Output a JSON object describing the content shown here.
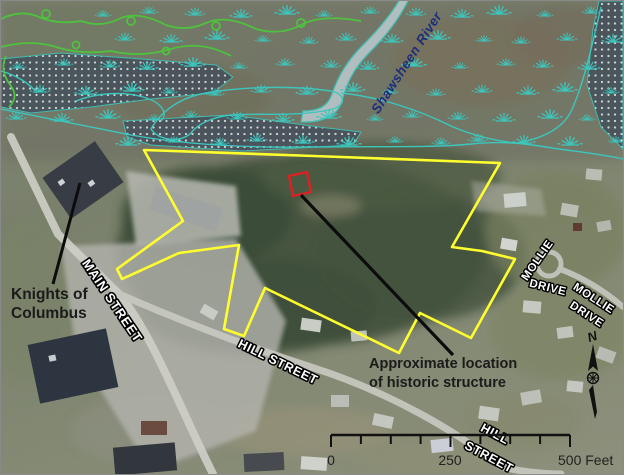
{
  "map": {
    "annotations": {
      "knights_line1": "Knights of",
      "knights_line2": "Columbus",
      "approx_line1": "Approximate location",
      "approx_line2": "of historic structure"
    },
    "streets": {
      "main": "MAIN STREET",
      "hill_upper": "HILL STREET",
      "hill_lower_line1": "HILL",
      "hill_lower_line2": "STREET",
      "mollie_a_line1": "MOLLIE",
      "mollie_a_line2": "DRIVE",
      "mollie_b_line1": "MOLLIE",
      "mollie_b_line2": "DRIVE"
    },
    "water": {
      "river_name": "Shawsheen River"
    },
    "scale_bar": {
      "label_start": "0",
      "label_mid": "250",
      "label_end": "500 Feet"
    },
    "north_arrow": {
      "letter": "N"
    },
    "colors": {
      "property_boundary": "#ffff2e",
      "structure_marker": "#e02020",
      "wetland_symbols": "#3cc6bd",
      "river_label_text": "#1d2f7a",
      "green_contours": "#4ec23e"
    }
  }
}
